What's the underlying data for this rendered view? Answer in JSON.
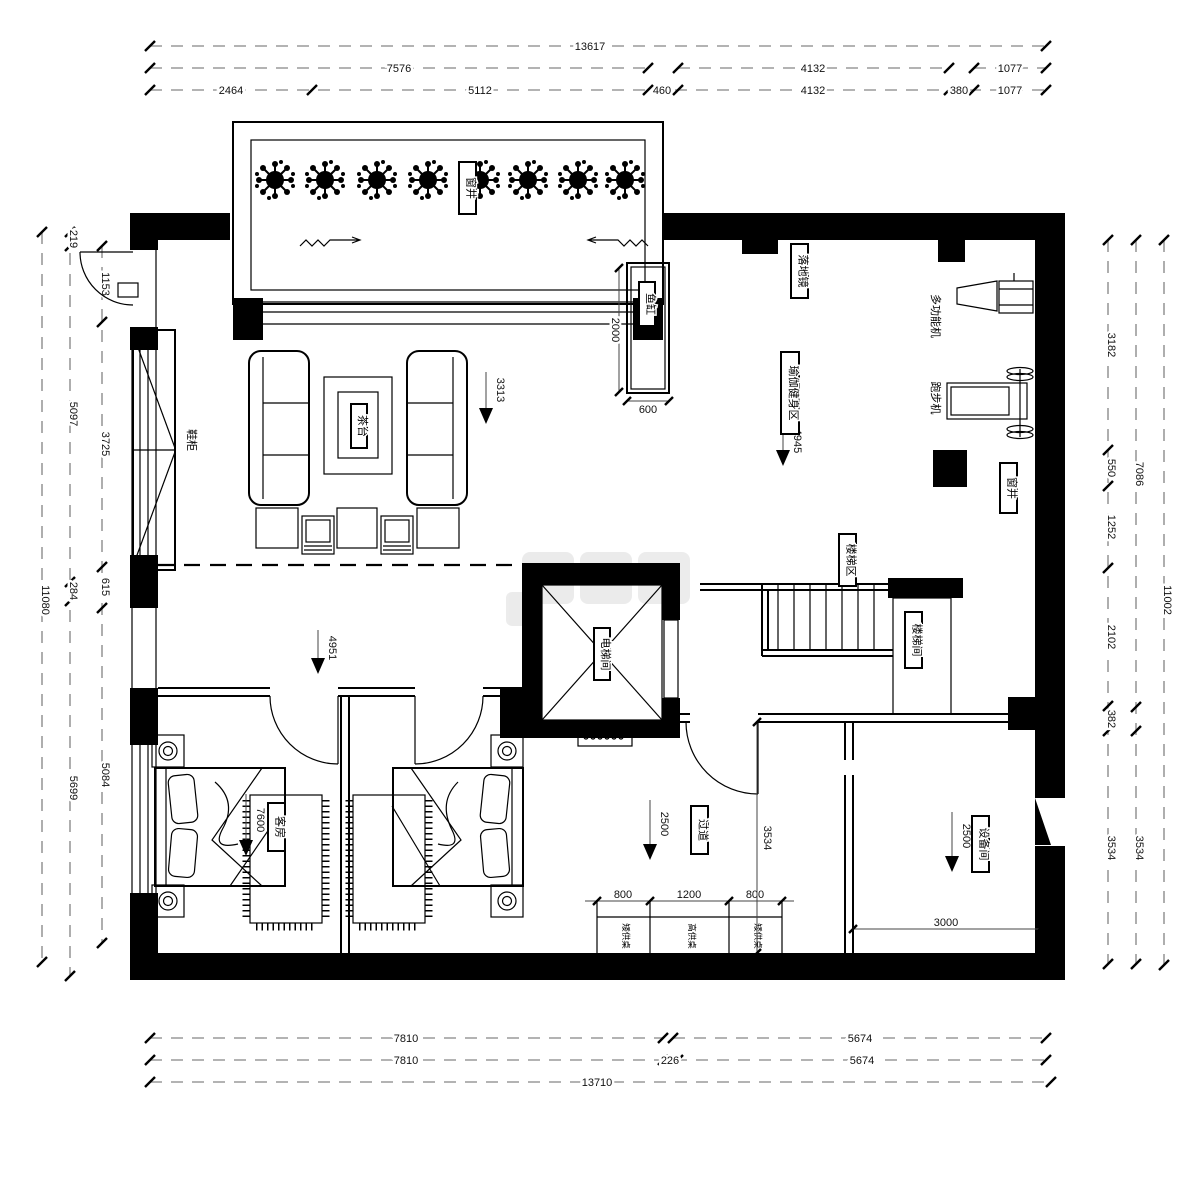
{
  "drawing": {
    "type": "residential floor plan",
    "units": "mm"
  },
  "labels": {
    "window_well_top": "窗井",
    "shoe_cabinet": "鞋柜",
    "tea_table": "茶台",
    "fish_tank": "鱼缸",
    "floor_mirror": "落地镜",
    "yoga_area": "瑜伽健身区",
    "multi_function_machine": "多功能机",
    "treadmill": "跑步机",
    "window_well_right": "窗井",
    "stair_area": "楼梯区",
    "stair_room": "楼梯间",
    "elevator_room": "电梯间",
    "guest_room": "客房",
    "corridor": "过道",
    "equipment_room": "设备间",
    "low_altar_table_left": "矮供桌",
    "high_altar_table": "高供桌",
    "low_altar_table_right": "矮供桌"
  },
  "elevations": {
    "living": "3313",
    "yoga": "4945",
    "hall": "4951",
    "guest": "7600",
    "corridor": "2500",
    "equipment": "2500"
  },
  "dims": {
    "top": {
      "total": "13617",
      "row2": [
        "7576",
        "4132",
        "1077"
      ],
      "row3": [
        "2464",
        "5112",
        "460",
        "4132",
        "380",
        "1077"
      ]
    },
    "left": {
      "total": "11080",
      "mid": [
        "219",
        "5097",
        "284",
        "5699"
      ],
      "inner": [
        "1153",
        "3725",
        "615",
        "5084"
      ]
    },
    "right": {
      "total": "11002",
      "mid": [
        "7086",
        "3534"
      ],
      "inner": [
        "3182",
        "550",
        "1252",
        "2102",
        "382",
        "3534"
      ]
    },
    "bottom": {
      "total": "13710",
      "row1": [
        "7810",
        "5674"
      ],
      "row2": [
        "7810",
        "226",
        "5674"
      ]
    },
    "interior": {
      "fish_h": "2000",
      "fish_w": "600",
      "desk": [
        "800",
        "1200",
        "800"
      ],
      "equip_w": "3000",
      "corridor_h": "3534"
    }
  },
  "colors": {
    "wall": "#000000",
    "dim_line": "#9a9a9a",
    "text": "#111111"
  }
}
